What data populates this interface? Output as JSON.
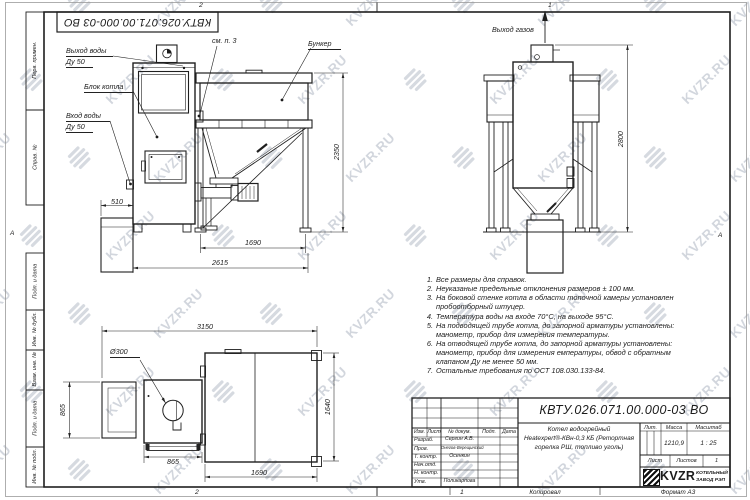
{
  "sheet": {
    "doc_number": "КВТУ.026.071.00.000-03 ВО",
    "format_label": "Формат А3",
    "copied_label": "Копировал",
    "zone_top_left": "2",
    "zone_top_right": "1",
    "zone_bottom_left": "2",
    "zone_bottom_right": "1",
    "zone_letter_left": "А",
    "zone_letter_right": "А",
    "side_column": [
      "Перв. примен.",
      "Справ. №",
      "Подп. и дата",
      "Инв. № дубл.",
      "Взам. инв. №",
      "Подп. и дата",
      "Инв. № подл."
    ]
  },
  "watermark": {
    "text": "KVZR.RU",
    "color": "#aeb6c3"
  },
  "front_view": {
    "labels": {
      "water_out_line1": "Выход воды",
      "water_out_line2": "Ду 50",
      "boiler_block": "Блок котла",
      "water_in_line1": "Вход воды",
      "water_in_line2": "Ду 50",
      "see_note": "см. п. 3",
      "bunker": "Бункер"
    },
    "dims": {
      "pedestal": "510",
      "height": "2350",
      "bunker_width": "1690",
      "total_width": "2615"
    }
  },
  "side_view": {
    "labels": {
      "gas_out": "Выход газов"
    },
    "dims": {
      "height": "2800"
    }
  },
  "plan_view": {
    "labels": {
      "bore": "Ø300"
    },
    "dims": {
      "total": "3150",
      "pedestal_depth": "865",
      "boiler_width": "865",
      "bunker_width": "1690",
      "bunker_depth": "1640"
    }
  },
  "notes": {
    "items": [
      {
        "num": "1.",
        "lines": [
          "Все размеры для справок."
        ]
      },
      {
        "num": "2.",
        "lines": [
          "Неуказаные предельные отклонения размеров ± 100 мм."
        ]
      },
      {
        "num": "3.",
        "lines": [
          "На боковой стенке котла в области топочной камеры установлен",
          "пробоотборный штуцер."
        ]
      },
      {
        "num": "4.",
        "lines": [
          "Температура воды на входе 70°С, на выходе 95°С."
        ]
      },
      {
        "num": "5.",
        "lines": [
          "На подводящей трубе котла, до запорной арматуры установлены:",
          "манометр, прибор для измерения температуры."
        ]
      },
      {
        "num": "6.",
        "lines": [
          "На отводящей трубе котла, до запорной арматуры установлены:",
          "манометр, прибор для измерения емпературы, обвод с обратным",
          "клапаном Ду не менее 50 мм."
        ]
      },
      {
        "num": "7.",
        "lines": [
          "Остальные требования по ОСТ 108.030.133-84."
        ]
      }
    ]
  },
  "title_block": {
    "doc_number": "КВТУ.026.071.00.000-03 ВО",
    "product_lines": [
      "Котел водогрейный",
      "Heatexpert®-КВн-0,3 КБ (Ретортная",
      "горелка РШ, топливо уголь)"
    ],
    "header_cols": {
      "izm": "Изм.",
      "list": "Лист",
      "doc": "№ докум.",
      "podp": "Подп.",
      "data": "Дата"
    },
    "rows": [
      {
        "role": "Разраб.",
        "name": "Сергин А.В."
      },
      {
        "role": "Пров.",
        "name": "Онегов-Верещинский"
      },
      {
        "role": "Т. контр.",
        "name": "Осенкин"
      },
      {
        "role": "Нач.отд.",
        "name": ""
      },
      {
        "role": "Н. контр.",
        "name": ""
      },
      {
        "role": "Утв.",
        "name": "Поликарпова"
      }
    ],
    "lit_label": "Лит.",
    "mass_label": "Масса",
    "scale_label": "Масштаб",
    "mass": "1210,9",
    "scale": "1 : 25",
    "sheet_label": "Лист",
    "sheets_label": "Листов",
    "sheets_count": "1",
    "brand": {
      "logo_text": "KVZR",
      "company_line1": "КОТЕЛЬНЫЙ",
      "company_line2": "ЗАВОД РЭП"
    }
  }
}
